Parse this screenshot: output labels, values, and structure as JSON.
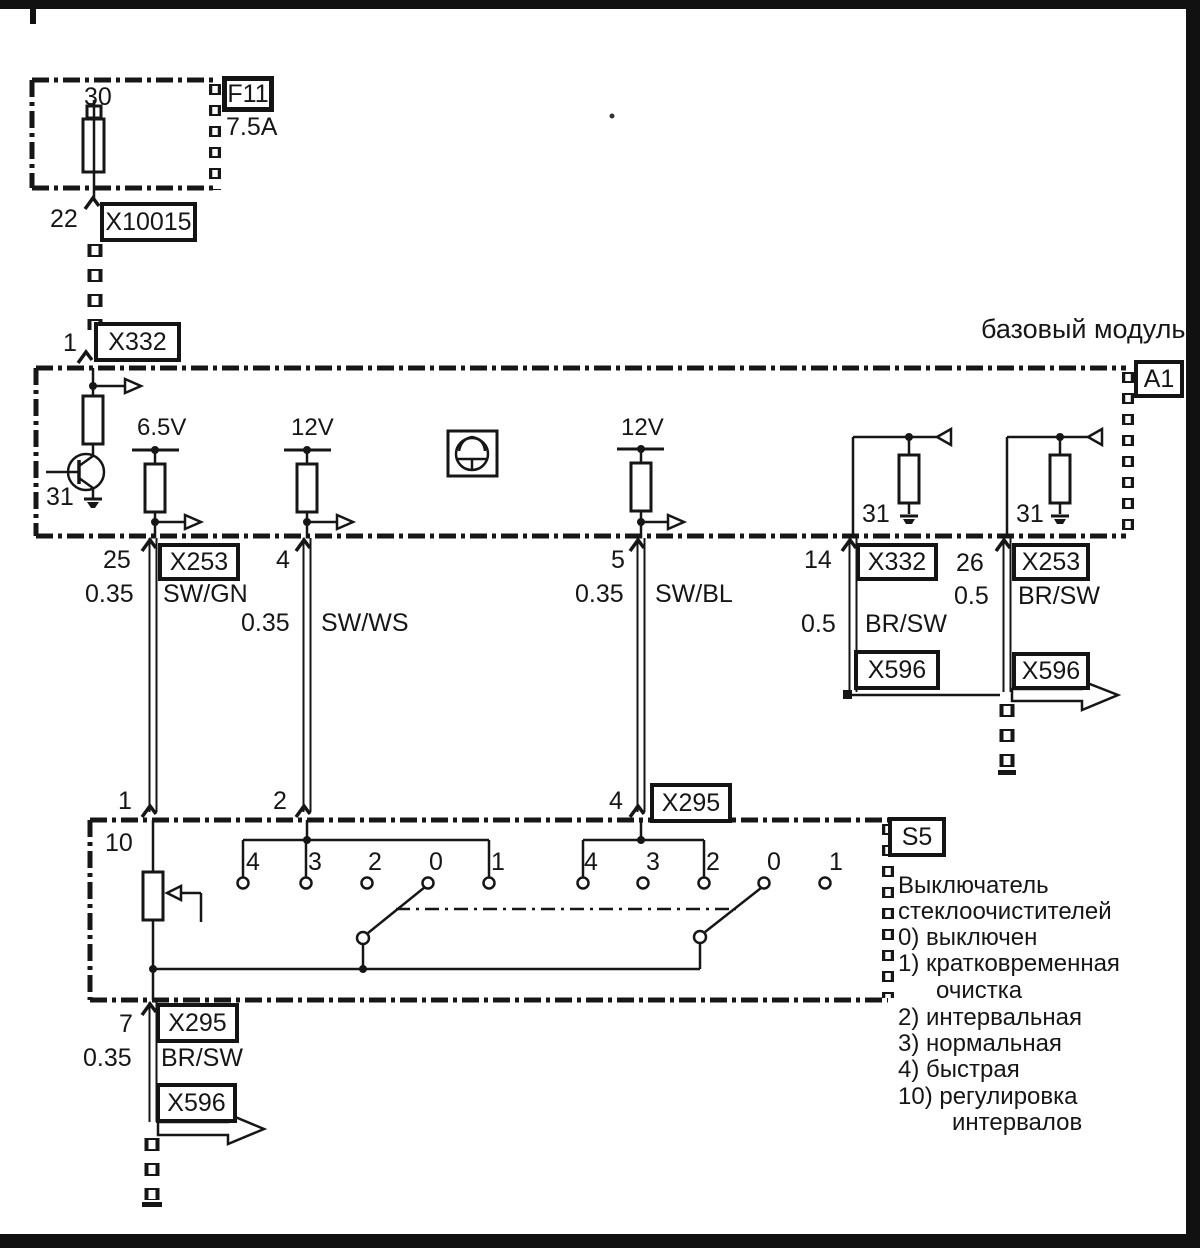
{
  "frame": {
    "module_title": "базовый модуль"
  },
  "fuse_circuit": {
    "terminal_30": "30",
    "fuse_id": "F11",
    "fuse_rating": "7.5A",
    "pin_22": "22",
    "connector_x10015": "X10015",
    "pin_1": "1",
    "connector_x332": "X332"
  },
  "module_a1": {
    "id": "A1",
    "terminal_31_left": "31",
    "rail_6_5v": "6.5V",
    "rail_12v_1": "12V",
    "rail_12v_2": "12V",
    "terminal_31_mid": "31",
    "terminal_31_right": "31"
  },
  "harness": {
    "w25": {
      "pin": "25",
      "connector": "X253",
      "gauge": "0.35",
      "color": "SW/GN",
      "pin_s5": "1"
    },
    "w4": {
      "pin": "4",
      "gauge": "0.35",
      "color": "SW/WS",
      "pin_s5": "2"
    },
    "w5": {
      "pin": "5",
      "gauge": "0.35",
      "color": "SW/BL",
      "pin_s5": "4",
      "connector_s5": "X295"
    },
    "w14": {
      "pin": "14",
      "connector": "X332",
      "gauge": "0.5",
      "color": "BR/SW",
      "connector_out": "X596"
    },
    "w26": {
      "pin": "26",
      "connector": "X253",
      "gauge": "0.5",
      "color": "BR/SW",
      "connector_out": "X596"
    },
    "w7": {
      "pin": "7",
      "connector": "X295",
      "gauge": "0.35",
      "color": "BR/SW",
      "connector_out": "X596"
    }
  },
  "switch_s5": {
    "id": "S5",
    "pin_10": "10",
    "group1": [
      "4",
      "3",
      "2",
      "0",
      "1"
    ],
    "group2": [
      "4",
      "3",
      "2",
      "0",
      "1"
    ]
  },
  "legend": {
    "lines": [
      "Выключатель",
      "стеклоочистителей",
      "0) выключен",
      "1) кратковременная",
      "очистка",
      "2) интервальная",
      "3) нормальная",
      "4) быстрая",
      "10) регулировка",
      "интервалов"
    ]
  },
  "colors": {
    "ink": "#161616",
    "paper": "#ffffff"
  }
}
